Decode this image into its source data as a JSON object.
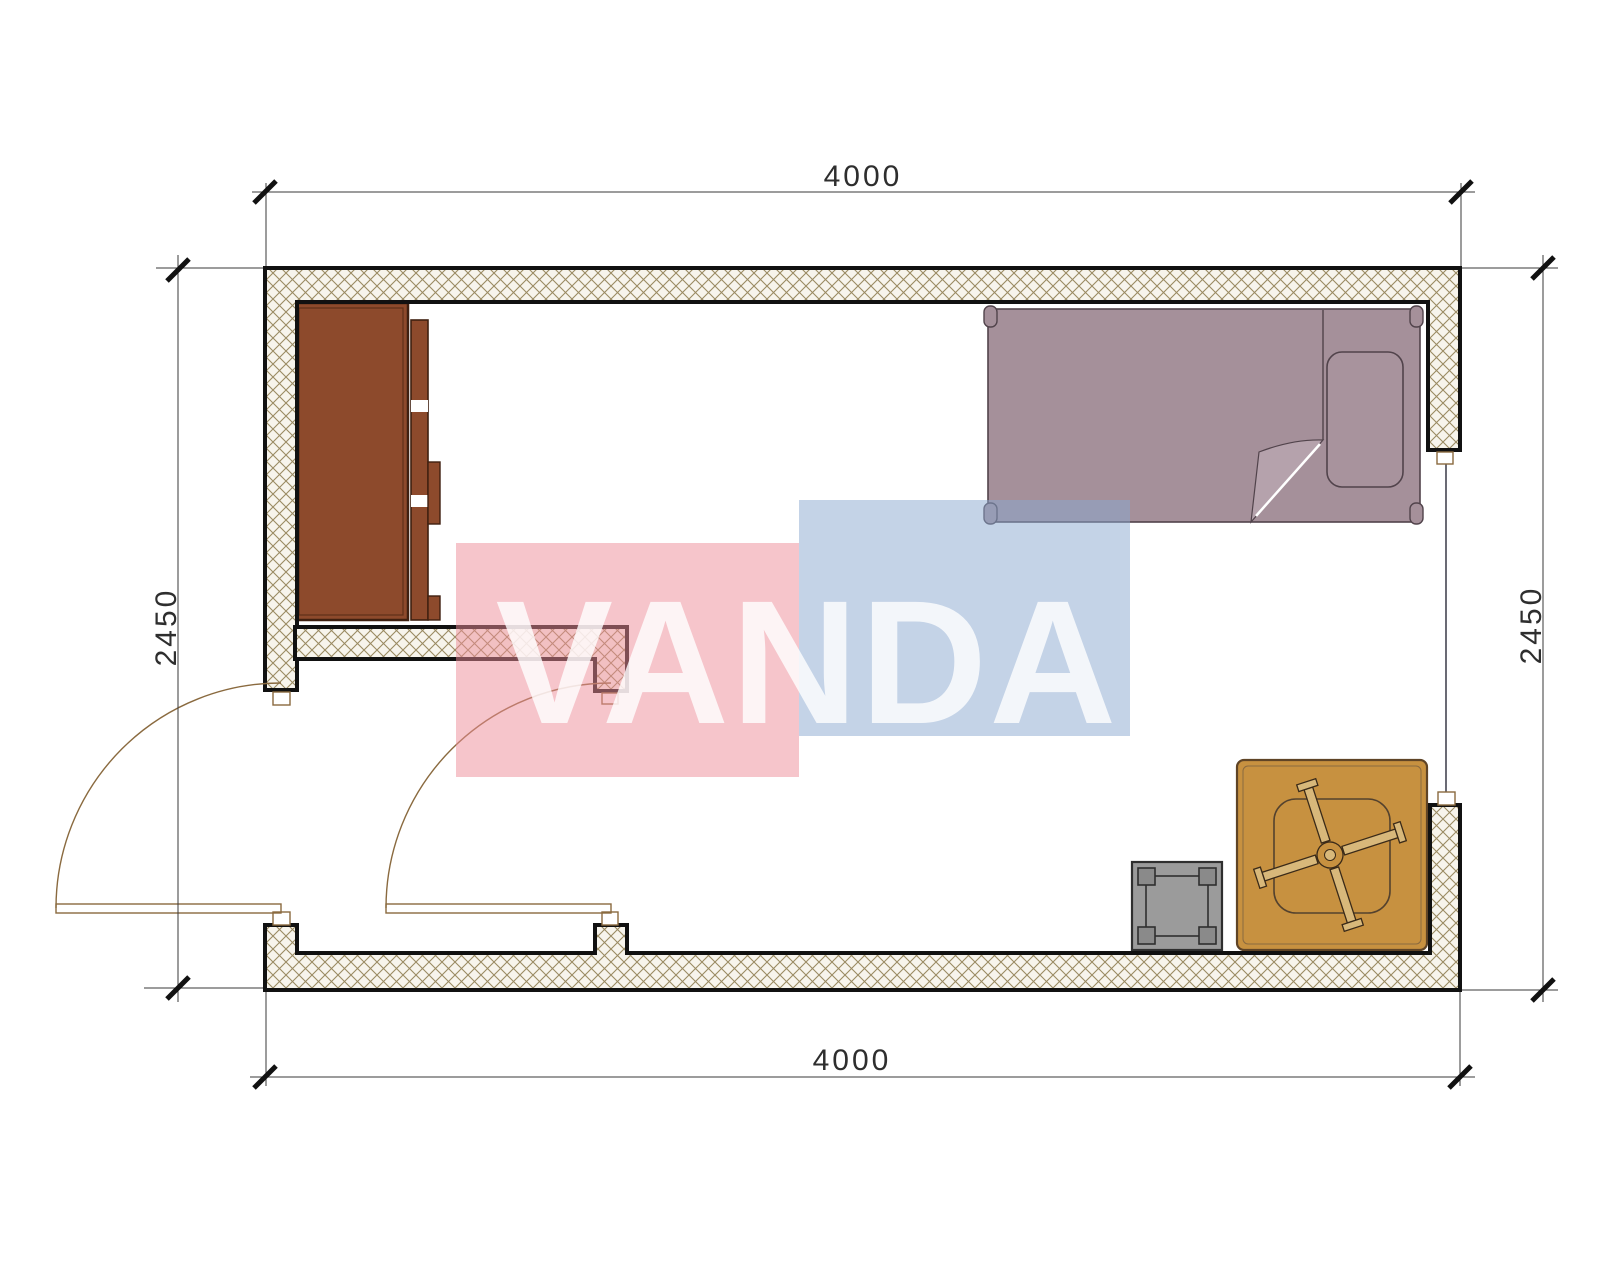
{
  "page": {
    "background": "#ffffff"
  },
  "watermark": {
    "text": "VANDA",
    "red_rect_color": "#ed8b97",
    "blue_rect_color": "#89a7cf"
  },
  "dimensions": {
    "top_width_mm": "4000",
    "bottom_width_mm": "4000",
    "left_height_mm": "2450",
    "right_height_mm": "2450"
  },
  "colors": {
    "wall_outline": "#111111",
    "hatch_line": "#9a8a62",
    "hatch_background": "#f7f4ec",
    "wardrobe": "#8d4a2c",
    "wardrobe_outline": "#3f2010",
    "bed": "#a5909a",
    "bed_outline": "#51434b",
    "pillow": "#a8939d",
    "blanket_fold": "#b5a2ac",
    "table": "#c79140",
    "table_outline": "#5f4426",
    "fan_blade": "#d8b87a",
    "stool": "#9b9b9b",
    "stool_outline": "#2f2f2f",
    "door_line": "#8a6a3f",
    "dimension_text": "#2e2e2e"
  }
}
